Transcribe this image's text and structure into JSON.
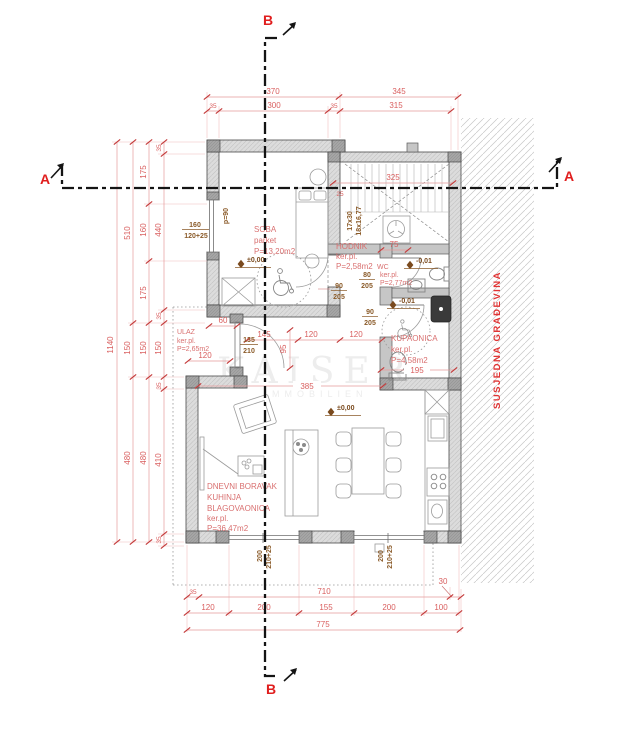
{
  "plan": {
    "sections": {
      "a": "A",
      "b": "B"
    },
    "watermark": {
      "brand": "KAISER",
      "sub": "IMMOBILIEN"
    },
    "neighbor_label": "SUSJEDNA GRAĐEVINA",
    "rooms": {
      "soba": {
        "name": "SOBA",
        "finish": "parket",
        "area": "P=13,20m2",
        "level": "±0,00"
      },
      "hodnik": {
        "name": "HODNIK",
        "finish": "ker.pl.",
        "area": "P=2,58m2"
      },
      "wc": {
        "name": "WC",
        "finish": "ker.pl.",
        "area": "P=2,77m2",
        "level": "-0,01"
      },
      "kupaonica": {
        "name": "KUPAONICA",
        "finish": "ker.pl.",
        "area": "P=4,58m2",
        "level": "-0,01"
      },
      "ulaz": {
        "name": "ULAZ",
        "finish": "ker.pl.",
        "area": "P=2,65m2"
      },
      "living": {
        "name1": "DNEVNI BORAVAK",
        "name2": "KUHINJA",
        "name3": "BLAGOVAONICA",
        "finish": "ker.pl.",
        "area": "P=36,47m2",
        "level": "±0,00"
      }
    },
    "stairs": {
      "treads": "17x30",
      "risers": "18x16,77"
    },
    "openings": {
      "soba_window": {
        "w": "160",
        "h": "120+25"
      },
      "parapet": "p=90",
      "door_soba": {
        "w": "90",
        "h": "205"
      },
      "door_wc": {
        "w": "80",
        "h": "205"
      },
      "door_bath": {
        "w": "90",
        "h": "205"
      },
      "door_entry": {
        "w": "135",
        "h": "210"
      },
      "south_window": {
        "w": "200",
        "h": "210+25"
      }
    },
    "dims": {
      "top1": [
        "370",
        "345"
      ],
      "top2": [
        "35",
        "300",
        "35",
        "315"
      ],
      "left1": [
        "1140"
      ],
      "left2": [
        "510",
        "150",
        "480"
      ],
      "left3": [
        "175",
        "160",
        "175",
        "150",
        "480"
      ],
      "left4": [
        "35",
        "440",
        "35",
        "150",
        "35",
        "410",
        "35"
      ],
      "bottom1": [
        "35",
        "710",
        "30"
      ],
      "bottom2": [
        "120",
        "200",
        "155",
        "200",
        "100"
      ],
      "bottom3": [
        "775"
      ],
      "stair_width": "325",
      "stair_note": "25",
      "stair_flight": "75",
      "entry_offset": "60",
      "hall_a": "145",
      "hall_b": "120",
      "hall_c": "120",
      "hall_depth": "95",
      "entry_width": "120",
      "living_span": "385",
      "bath_span": "195"
    }
  }
}
